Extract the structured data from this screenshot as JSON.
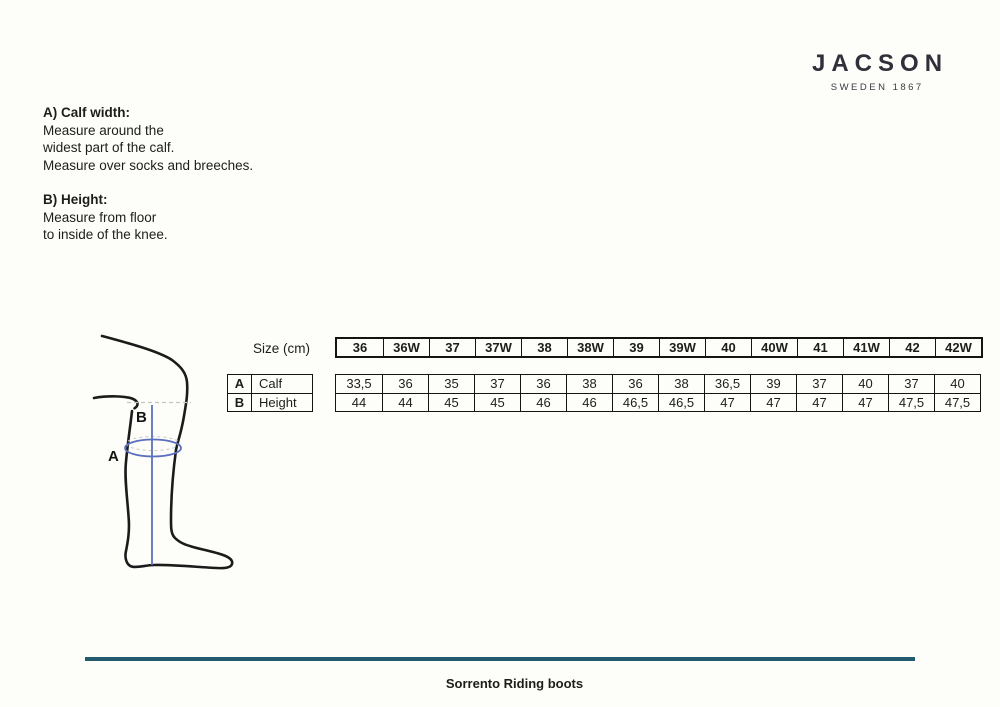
{
  "logo": {
    "brand": "JACSON",
    "tagline": "SWEDEN 1867"
  },
  "instructions": {
    "section_a": {
      "heading": "A) Calf width:",
      "lines": [
        "Measure around the",
        "widest part of the calf.",
        "Measure over socks and breeches."
      ]
    },
    "section_b": {
      "heading": "B) Height:",
      "lines": [
        "Measure from floor",
        "to inside of the knee."
      ]
    }
  },
  "figure": {
    "label_a": "A",
    "label_b": "B"
  },
  "size_table": {
    "unit_label": "Size (cm)",
    "row_labels": [
      {
        "key": "A",
        "label": "Calf"
      },
      {
        "key": "B",
        "label": "Height"
      }
    ],
    "sizes": [
      "36",
      "36W",
      "37",
      "37W",
      "38",
      "38W",
      "39",
      "39W",
      "40",
      "40W",
      "41",
      "41W",
      "42",
      "42W"
    ],
    "calf": [
      "33,5",
      "36",
      "35",
      "37",
      "36",
      "38",
      "36",
      "38",
      "36,5",
      "39",
      "37",
      "40",
      "37",
      "40"
    ],
    "height": [
      "44",
      "44",
      "45",
      "45",
      "46",
      "46",
      "46,5",
      "46,5",
      "47",
      "47",
      "47",
      "47",
      "47,5",
      "47,5"
    ]
  },
  "footer": {
    "product_name": "Sorrento Riding boots"
  },
  "colors": {
    "ink": "#1d1d1b",
    "logo": "#30303a",
    "measure_blue": "#5b6fbe",
    "dash_gray": "#c4c4c4",
    "rule_teal": "#235c6e",
    "background": "#fdfdfa"
  }
}
